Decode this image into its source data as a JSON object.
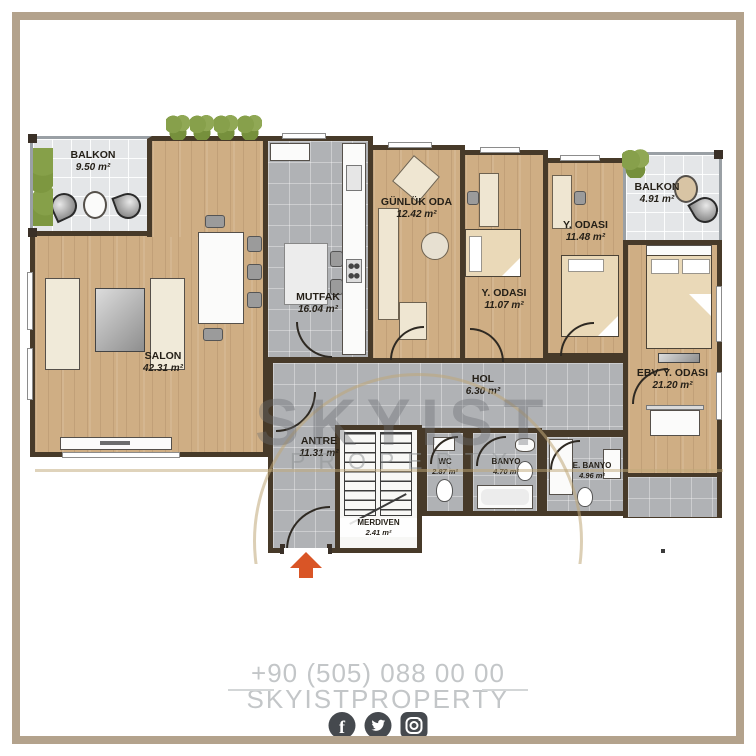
{
  "plan": {
    "rooms": [
      {
        "name": "BALKON",
        "area": "9.50 m²"
      },
      {
        "name": "SALON",
        "area": "42.31 m²"
      },
      {
        "name": "MUTFAK",
        "area": "16.04 m²"
      },
      {
        "name": "GÜNLÜK ODA",
        "area": "12.42 m²"
      },
      {
        "name": "Y. ODASI",
        "area": "11.07 m²"
      },
      {
        "name": "Y. ODASI",
        "area": "11.48 m²"
      },
      {
        "name": "BALKON",
        "area": "4.91 m²"
      },
      {
        "name": "EBV. Y. ODASI",
        "area": "21.20 m²"
      },
      {
        "name": "HOL",
        "area": "6.30 m²"
      },
      {
        "name": "ANTRE",
        "area": "11.31 m²"
      },
      {
        "name": "MERDIVEN",
        "area": "2.41 m²"
      },
      {
        "name": "WC",
        "area": "2.87 m²"
      },
      {
        "name": "BANYO",
        "area": "4.70 m²"
      },
      {
        "name": "E. BANYO",
        "area": "4.96 m²"
      }
    ]
  },
  "watermark": {
    "line1": "SKYIST",
    "line2": "PROPERTY"
  },
  "footer": {
    "phone": "+90 (505) 088 00 00",
    "brand": "SKYISTPROPERTY",
    "social": [
      "facebook-icon",
      "twitter-icon",
      "instagram-icon"
    ]
  },
  "colors": {
    "frame": "#b3a28c",
    "wall": "#473a29",
    "wood": "#cfae84",
    "tile_gray": "#b0b2b5",
    "tile_light": "#e4e6e8",
    "arrow": "#d95526",
    "footer_text": "#c3c6c8"
  }
}
